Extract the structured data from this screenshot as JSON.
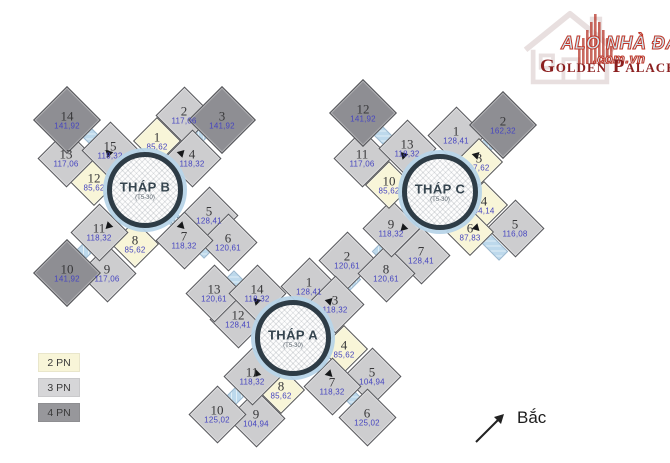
{
  "logo": {
    "alo_line1": "ALO NHÀ ĐẤT",
    "alo_line2": ".com.vn",
    "brand": "Golden Palace",
    "brand_color": "#8b1f1f",
    "alo_fill_color": "#cfe9f3",
    "alo_outline_color": "#c0392b"
  },
  "legend": {
    "items": [
      {
        "label": "2 PN",
        "color": "#f8f5d8"
      },
      {
        "label": "3 PN",
        "color": "#d6d6d8"
      },
      {
        "label": "4 PN",
        "color": "#97979b"
      }
    ]
  },
  "compass": {
    "label": "Bắc"
  },
  "colors": {
    "unit_2pn": "#f8f5d8",
    "unit_3pn": "#cdcdcf",
    "unit_4pn": "#8e8e93",
    "corridor": "#bdd9ec",
    "circle_ring": "#2e3c46",
    "unit_number_text": "#38383a",
    "unit_area_text": "#4645c0"
  },
  "towers": [
    {
      "key": "b",
      "name": "THÁP B",
      "floors": "(T5-30)",
      "cx": 145,
      "cy": 190,
      "units": [
        {
          "n": "1",
          "area": "85,62",
          "x": 157,
          "y": 141,
          "type": "2pn"
        },
        {
          "n": "2",
          "area": "117,06",
          "x": 184,
          "y": 115,
          "type": "3pn"
        },
        {
          "n": "3",
          "area": "141,92",
          "x": 222,
          "y": 120,
          "type": "4pn"
        },
        {
          "n": "4",
          "area": "118,32",
          "x": 192,
          "y": 158,
          "type": "3pn"
        },
        {
          "n": "5",
          "area": "128,41",
          "x": 209,
          "y": 215,
          "type": "3pn"
        },
        {
          "n": "6",
          "area": "120,61",
          "x": 228,
          "y": 242,
          "type": "3pn"
        },
        {
          "n": "7",
          "area": "118,32",
          "x": 184,
          "y": 240,
          "type": "3pn"
        },
        {
          "n": "8",
          "area": "85,62",
          "x": 135,
          "y": 244,
          "type": "2pn"
        },
        {
          "n": "9",
          "area": "117,06",
          "x": 107,
          "y": 273,
          "type": "3pn"
        },
        {
          "n": "10",
          "area": "141,92",
          "x": 67,
          "y": 273,
          "type": "4pn"
        },
        {
          "n": "11",
          "area": "118,32",
          "x": 99,
          "y": 232,
          "type": "3pn"
        },
        {
          "n": "12",
          "area": "85,62",
          "x": 94,
          "y": 182,
          "type": "2pn"
        },
        {
          "n": "13",
          "area": "117,06",
          "x": 66,
          "y": 158,
          "type": "3pn"
        },
        {
          "n": "14",
          "area": "141,92",
          "x": 67,
          "y": 120,
          "type": "4pn"
        },
        {
          "n": "15",
          "area": "118,32",
          "x": 110,
          "y": 150,
          "type": "3pn"
        }
      ]
    },
    {
      "key": "a",
      "name": "THÁP A",
      "floors": "(T5-30)",
      "cx": 293,
      "cy": 338,
      "units": [
        {
          "n": "1",
          "area": "128,41",
          "x": 309,
          "y": 286,
          "type": "3pn"
        },
        {
          "n": "2",
          "area": "120,61",
          "x": 347,
          "y": 260,
          "type": "3pn"
        },
        {
          "n": "3",
          "area": "118,32",
          "x": 335,
          "y": 304,
          "type": "3pn"
        },
        {
          "n": "4",
          "area": "85,62",
          "x": 344,
          "y": 349,
          "type": "2pn"
        },
        {
          "n": "5",
          "area": "104,94",
          "x": 372,
          "y": 376,
          "type": "3pn"
        },
        {
          "n": "6",
          "area": "125,02",
          "x": 367,
          "y": 417,
          "type": "3pn"
        },
        {
          "n": "7",
          "area": "118,32",
          "x": 332,
          "y": 386,
          "type": "3pn"
        },
        {
          "n": "8",
          "area": "85,62",
          "x": 281,
          "y": 390,
          "type": "2pn"
        },
        {
          "n": "9",
          "area": "104,94",
          "x": 256,
          "y": 418,
          "type": "3pn"
        },
        {
          "n": "10",
          "area": "125,02",
          "x": 217,
          "y": 414,
          "type": "3pn"
        },
        {
          "n": "11",
          "area": "118,32",
          "x": 252,
          "y": 376,
          "type": "3pn"
        },
        {
          "n": "12",
          "area": "128,41",
          "x": 238,
          "y": 319,
          "type": "3pn"
        },
        {
          "n": "13",
          "area": "120,61",
          "x": 214,
          "y": 293,
          "type": "3pn"
        },
        {
          "n": "14",
          "area": "118,32",
          "x": 257,
          "y": 293,
          "type": "3pn"
        }
      ]
    },
    {
      "key": "c",
      "name": "THÁP C",
      "floors": "(T5-30)",
      "cx": 440,
      "cy": 192,
      "units": [
        {
          "n": "1",
          "area": "128,41",
          "x": 456,
          "y": 135,
          "type": "3pn"
        },
        {
          "n": "2",
          "area": "162,32",
          "x": 503,
          "y": 125,
          "type": "4pn"
        },
        {
          "n": "3",
          "area": "87,62",
          "x": 479,
          "y": 162,
          "type": "2pn"
        },
        {
          "n": "4",
          "area": "94,14",
          "x": 484,
          "y": 205,
          "type": "2pn"
        },
        {
          "n": "5",
          "area": "116,08",
          "x": 515,
          "y": 228,
          "type": "3pn"
        },
        {
          "n": "6",
          "area": "87,83",
          "x": 470,
          "y": 232,
          "type": "2pn"
        },
        {
          "n": "7",
          "area": "128,41",
          "x": 421,
          "y": 255,
          "type": "3pn"
        },
        {
          "n": "8",
          "area": "120,61",
          "x": 386,
          "y": 273,
          "type": "3pn"
        },
        {
          "n": "9",
          "area": "118,32",
          "x": 391,
          "y": 228,
          "type": "3pn"
        },
        {
          "n": "10",
          "area": "85,62",
          "x": 389,
          "y": 185,
          "type": "2pn"
        },
        {
          "n": "11",
          "area": "117,06",
          "x": 362,
          "y": 158,
          "type": "3pn"
        },
        {
          "n": "12",
          "area": "141,92",
          "x": 363,
          "y": 113,
          "type": "4pn"
        },
        {
          "n": "13",
          "area": "118,32",
          "x": 407,
          "y": 148,
          "type": "3pn"
        }
      ]
    }
  ]
}
